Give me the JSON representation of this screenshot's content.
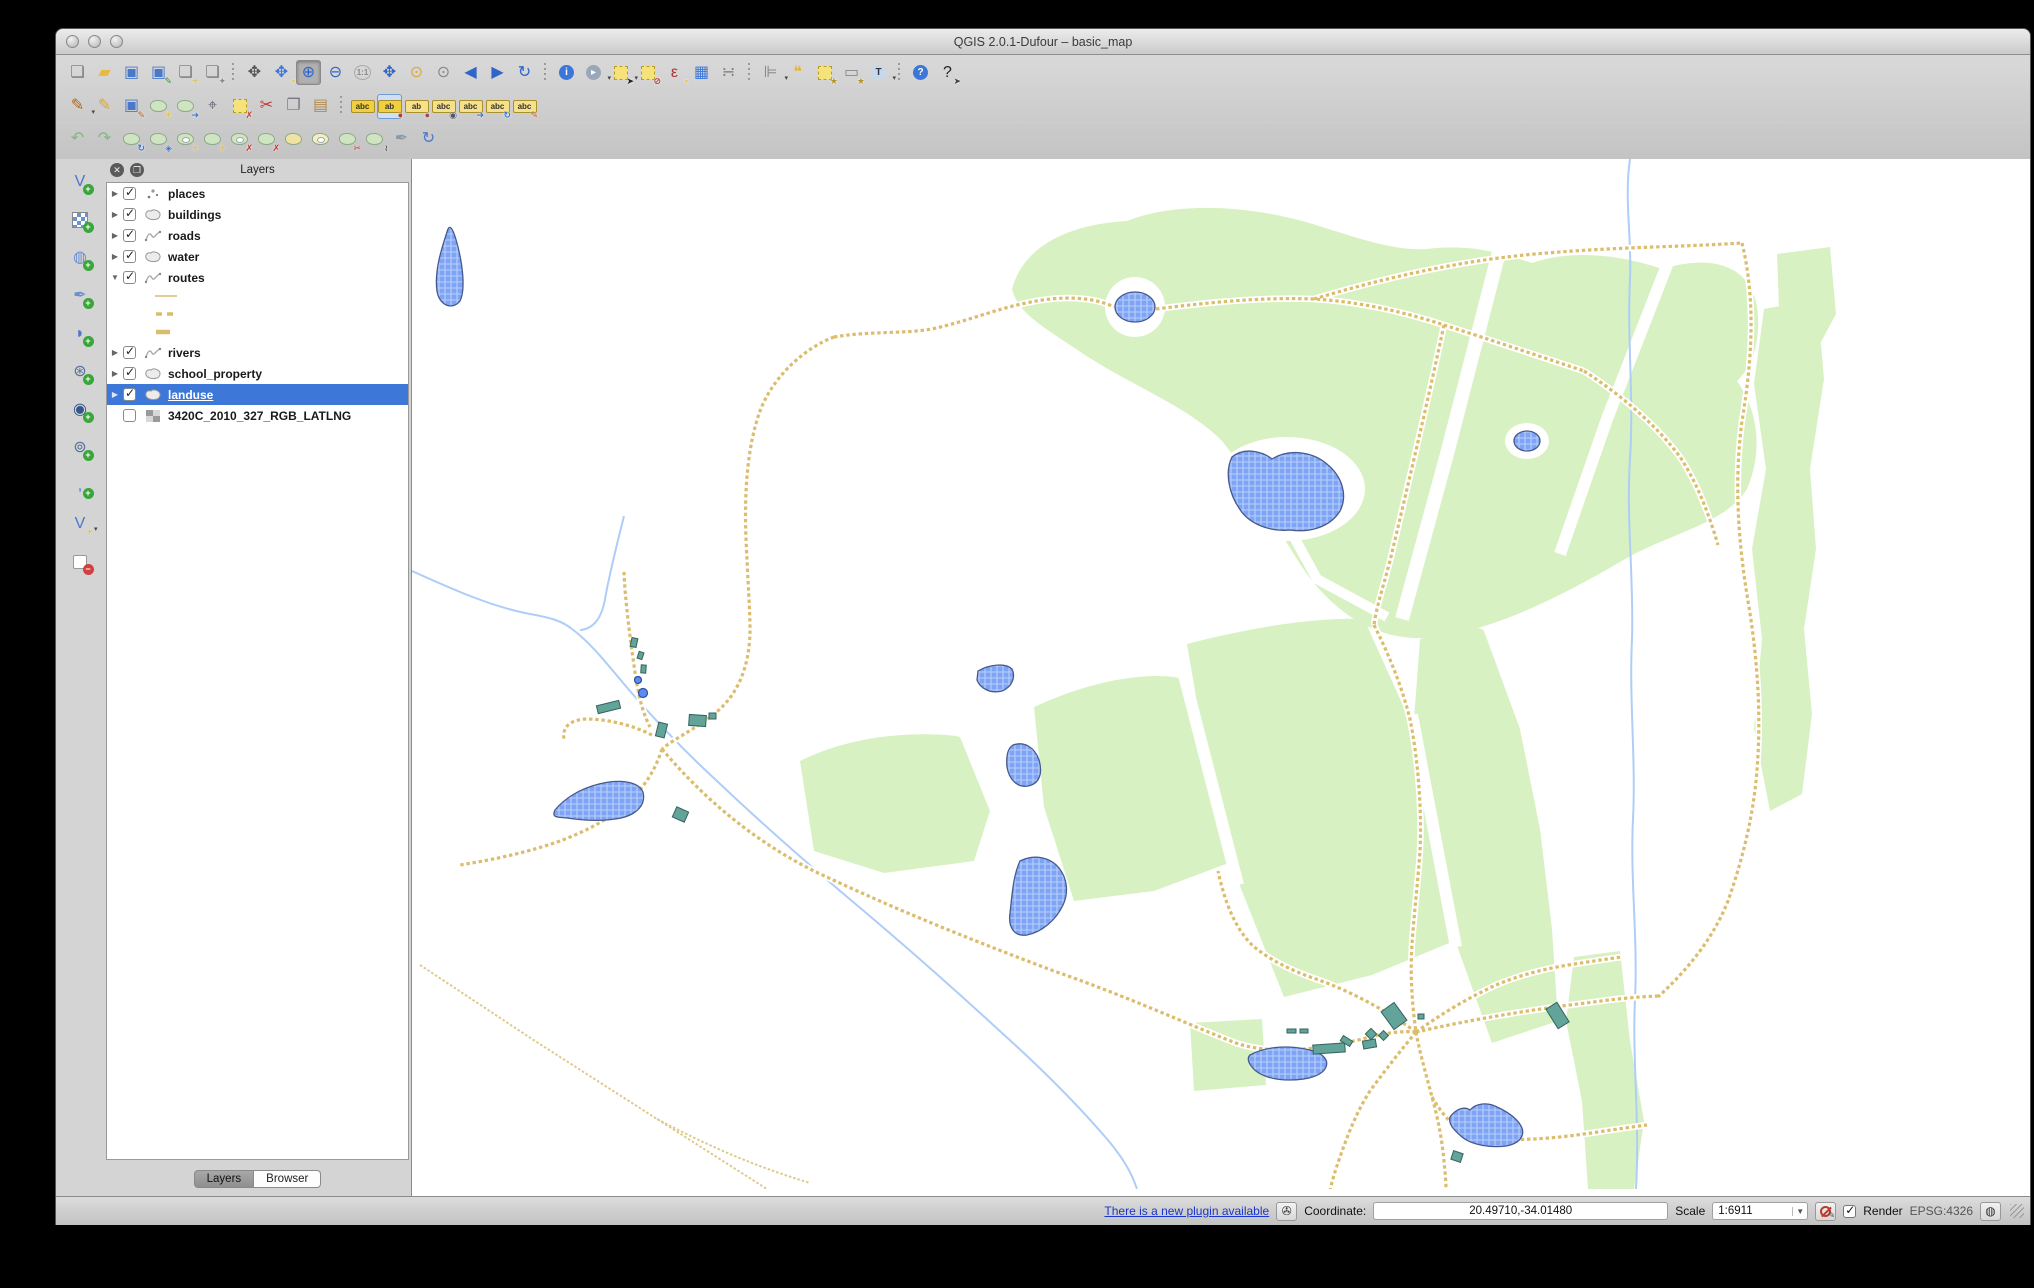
{
  "window": {
    "title": "QGIS 2.0.1-Dufour – basic_map"
  },
  "colors": {
    "selection_blue": "#3d78d8",
    "landuse_green": "#d8f1c2",
    "water_fill": "#7da4f5",
    "water_border": "#46598f",
    "route_tan": "#dcbd6e",
    "river_blue": "#aecdf7",
    "building_teal": "#62a39a",
    "link_blue": "#1a35cc"
  },
  "toolbars": {
    "row1": [
      {
        "n": "new-project-button",
        "k": "g",
        "g": "❏",
        "c": "#777"
      },
      {
        "n": "open-project-button",
        "k": "g",
        "g": "▰",
        "c": "#e9b93f"
      },
      {
        "n": "save-project-button",
        "k": "g",
        "g": "▣",
        "c": "#4a79c9"
      },
      {
        "n": "save-project-as-button",
        "k": "g",
        "g": "▣",
        "c": "#4a79c9",
        "b": "✎",
        "bc": "#2a8a2a"
      },
      {
        "n": "new-print-composer-button",
        "k": "g",
        "g": "❏",
        "c": "#777",
        "b": "✳",
        "bc": "#d8b93c"
      },
      {
        "n": "composer-manager-button",
        "k": "g",
        "g": "❏",
        "c": "#777",
        "b": "✦",
        "bc": "#888"
      },
      {
        "s": 1
      },
      {
        "n": "pan-map-button",
        "k": "g",
        "g": "✥",
        "c": "#555"
      },
      {
        "n": "pan-to-selection-button",
        "k": "g",
        "g": "✥",
        "c": "#3b76d8",
        "b": "▪",
        "bc": "#e8c83c"
      },
      {
        "n": "zoom-in-button",
        "k": "g",
        "g": "⊕",
        "c": "#2f66c8",
        "p": 1
      },
      {
        "n": "zoom-out-button",
        "k": "g",
        "g": "⊖",
        "c": "#2f66c8"
      },
      {
        "n": "zoom-actual-size-button",
        "k": "mini",
        "g": "1:1"
      },
      {
        "n": "zoom-full-extent-button",
        "k": "g",
        "g": "✥",
        "c": "#2f66c8"
      },
      {
        "n": "zoom-to-selection-button",
        "k": "g",
        "g": "⊙",
        "c": "#d8a93c"
      },
      {
        "n": "zoom-to-layer-button",
        "k": "g",
        "g": "⊙",
        "c": "#888"
      },
      {
        "n": "zoom-last-button",
        "k": "g",
        "g": "◀",
        "c": "#2f66c8"
      },
      {
        "n": "zoom-next-button",
        "k": "g",
        "g": "▶",
        "c": "#2f66c8"
      },
      {
        "n": "refresh-map-button",
        "k": "g",
        "g": "↻",
        "c": "#2f66c8"
      },
      {
        "s": 1
      },
      {
        "n": "identify-features-button",
        "k": "circ",
        "g": "i",
        "bg": "#3b76d8"
      },
      {
        "n": "run-feature-action-button",
        "k": "circ",
        "g": "▸",
        "bg": "#9aa7b8",
        "dd": 1
      },
      {
        "n": "select-features-button",
        "k": "sq",
        "b": "➤",
        "bc": "#222",
        "dd": 1
      },
      {
        "n": "deselect-features-button",
        "k": "sq",
        "b": "⊘",
        "bc": "#c0392b"
      },
      {
        "n": "select-by-expression-button",
        "k": "g",
        "g": "ε",
        "c": "#b03030",
        "b": "▪",
        "bc": "#e8c83c"
      },
      {
        "n": "open-attribute-table-button",
        "k": "g",
        "g": "▦",
        "c": "#3b76d8"
      },
      {
        "n": "field-calculator-button",
        "k": "g",
        "g": "∺",
        "c": "#777"
      },
      {
        "s": 1
      },
      {
        "n": "measure-line-button",
        "k": "g",
        "g": "⊫",
        "c": "#888",
        "dd": 1
      },
      {
        "n": "map-tips-button",
        "k": "g",
        "g": "❝",
        "c": "#e0b63c"
      },
      {
        "n": "new-bookmark-button",
        "k": "sq",
        "b": "★",
        "bc": "#b8932c"
      },
      {
        "n": "show-bookmarks-button",
        "k": "g",
        "g": "▭",
        "c": "#888",
        "b": "★",
        "bc": "#b8932c"
      },
      {
        "n": "text-annotation-button",
        "k": "circ",
        "g": "T",
        "bg": "#c8d8ec",
        "c": "#334",
        "dd": 1
      },
      {
        "s": 1
      },
      {
        "n": "help-contents-button",
        "k": "circ",
        "g": "?",
        "bg": "#3b76d8"
      },
      {
        "n": "whats-this-button",
        "k": "g",
        "g": "?",
        "c": "#222",
        "b": "➤",
        "bc": "#444"
      }
    ],
    "row2": [
      {
        "n": "current-edits-button",
        "k": "g",
        "g": "✎",
        "c": "#b5651d",
        "dd": 1
      },
      {
        "n": "toggle-editing-button",
        "k": "g",
        "g": "✎",
        "c": "#d8a93c"
      },
      {
        "n": "save-layer-edits-button",
        "k": "g",
        "g": "▣",
        "c": "#4a79c9",
        "b": "✎",
        "bc": "#b5651d"
      },
      {
        "n": "add-feature-button",
        "k": "blob",
        "b": "✳",
        "bc": "#d8b93c"
      },
      {
        "n": "move-feature-button",
        "k": "blob",
        "b": "➜",
        "bc": "#3b76d8"
      },
      {
        "n": "node-tool-button",
        "k": "g",
        "g": "⌖",
        "c": "#667"
      },
      {
        "n": "delete-selected-button",
        "k": "sq",
        "b": "✗",
        "bc": "#c0392b"
      },
      {
        "n": "cut-features-button",
        "k": "g",
        "g": "✂",
        "c": "#c0392b"
      },
      {
        "n": "copy-features-button",
        "k": "g",
        "g": "❐",
        "c": "#778"
      },
      {
        "n": "paste-features-button",
        "k": "g",
        "g": "▤",
        "c": "#b08a4a"
      },
      {
        "s": 1
      },
      {
        "n": "layer-labeling-options-button",
        "k": "tag",
        "g": "abc",
        "bg": "#f2cf3e"
      },
      {
        "n": "pin-unpin-labels-button",
        "k": "tag",
        "g": "ab",
        "bg": "#f2cf3e",
        "b": "●",
        "bc": "#c0392b",
        "p": 2
      },
      {
        "n": "highlight-pinned-labels-button",
        "k": "tag",
        "g": "ab",
        "bg": "#f6e08a",
        "b": "●",
        "bc": "#a04a5a"
      },
      {
        "n": "show-hide-labels-button",
        "k": "tag",
        "g": "abc",
        "bg": "#f6e08a",
        "b": "◉",
        "bc": "#556"
      },
      {
        "n": "move-label-button",
        "k": "tag",
        "g": "abc",
        "bg": "#f6e08a",
        "b": "➜",
        "bc": "#3b76d8"
      },
      {
        "n": "rotate-label-button",
        "k": "tag",
        "g": "abc",
        "bg": "#f6e08a",
        "b": "↻",
        "bc": "#3b76d8"
      },
      {
        "n": "change-label-properties-button",
        "k": "tag",
        "g": "abc",
        "bg": "#f6e08a",
        "b": "✎",
        "bc": "#b5651d"
      }
    ],
    "row3": [
      {
        "n": "undo-button",
        "k": "g",
        "g": "↶",
        "c": "#82b880"
      },
      {
        "n": "redo-button",
        "k": "g",
        "g": "↷",
        "c": "#82b880"
      },
      {
        "n": "rotate-feature-button",
        "k": "blob",
        "b": "↻",
        "bc": "#3b76d8"
      },
      {
        "n": "simplify-feature-button",
        "k": "blob",
        "b": "◈",
        "bc": "#3b76d8"
      },
      {
        "n": "add-ring-button",
        "k": "ring",
        "b": "✳",
        "bc": "#d8b93c"
      },
      {
        "n": "add-part-button",
        "k": "blob",
        "b": "✳",
        "bc": "#d8b93c"
      },
      {
        "n": "delete-ring-button",
        "k": "ring",
        "b": "✗",
        "bc": "#c0392b"
      },
      {
        "n": "delete-part-button",
        "k": "blob",
        "b": "✗",
        "bc": "#c0392b"
      },
      {
        "n": "fill-ring-button",
        "k": "blob",
        "bg": "#efe3a2"
      },
      {
        "n": "reshape-features-button",
        "k": "ring",
        "bg": "#f4eec2"
      },
      {
        "n": "split-features-button",
        "k": "blob",
        "b": "✂",
        "bc": "#c0392b"
      },
      {
        "n": "split-parts-button",
        "k": "blob",
        "b": "≀",
        "bc": "#556"
      },
      {
        "n": "offset-curve-button",
        "k": "g",
        "g": "✒",
        "c": "#8899aa"
      },
      {
        "n": "rotate-point-symbols-button",
        "k": "g",
        "g": "↻",
        "c": "#4a79c9"
      }
    ],
    "left": [
      {
        "n": "add-vector-layer-button",
        "k": "g",
        "g": "V",
        "c": "#4a79c9",
        "b": "+",
        "bbg": "#3aa53a"
      },
      {
        "n": "add-raster-layer-button",
        "k": "chk",
        "b": "+",
        "bbg": "#3aa53a"
      },
      {
        "n": "add-postgis-layer-button",
        "k": "g",
        "g": "◍",
        "c": "#6a8fd0",
        "b": "+",
        "bbg": "#3aa53a"
      },
      {
        "n": "add-spatialite-layer-button",
        "k": "g",
        "g": "✒",
        "c": "#6a8fd0",
        "b": "+",
        "bbg": "#3aa53a"
      },
      {
        "n": "add-mssql-layer-button",
        "k": "g",
        "g": "◗",
        "c": "#4a79c9",
        "b": "+",
        "bbg": "#3aa53a"
      },
      {
        "n": "add-wms-layer-button",
        "k": "g",
        "g": "⊛",
        "c": "#55719a",
        "b": "+",
        "bbg": "#3aa53a"
      },
      {
        "n": "add-wcs-layer-button",
        "k": "g",
        "g": "◉",
        "c": "#33578a",
        "b": "+",
        "bbg": "#3aa53a"
      },
      {
        "n": "add-wfs-layer-button",
        "k": "g",
        "g": "⊚",
        "c": "#55719a",
        "b": "+",
        "bbg": "#3aa53a"
      },
      {
        "n": "add-delimited-text-layer-button",
        "k": "g",
        "g": ",",
        "c": "#4a79c9",
        "b": "+",
        "bbg": "#3aa53a"
      },
      {
        "n": "new-shapefile-layer-button",
        "k": "g",
        "g": "V",
        "c": "#4a79c9",
        "b": "✳",
        "bc": "#d8b93c",
        "dd": 1
      },
      {
        "n": "remove-layer-button",
        "k": "sqw",
        "b": "−",
        "bbg": "#d04040"
      }
    ]
  },
  "layers_panel": {
    "title": "Layers",
    "tab_layers": "Layers",
    "tab_browser": "Browser",
    "layers": [
      {
        "name": "places",
        "icon": "point",
        "checked": true,
        "expander": "right"
      },
      {
        "name": "buildings",
        "icon": "polygon",
        "checked": true,
        "expander": "right"
      },
      {
        "name": "roads",
        "icon": "line",
        "checked": true,
        "expander": "right"
      },
      {
        "name": "water",
        "icon": "polygon",
        "checked": true,
        "expander": "right"
      },
      {
        "name": "routes",
        "icon": "line",
        "checked": true,
        "expander": "down",
        "children": [
          "line-solid",
          "line-dashes",
          "line-thick"
        ]
      },
      {
        "name": "rivers",
        "icon": "line",
        "checked": true,
        "expander": "right"
      },
      {
        "name": "school_property",
        "icon": "polygon",
        "checked": true,
        "expander": "right"
      },
      {
        "name": "landuse",
        "icon": "polygon",
        "checked": true,
        "expander": "right",
        "selected": true
      },
      {
        "name": "3420C_2010_327_RGB_LATLNG",
        "icon": "raster",
        "checked": false,
        "expander": "none"
      }
    ]
  },
  "status_bar": {
    "plugin_link": "There is a new plugin available",
    "coordinate_label": "Coordinate:",
    "coordinate_value": "20.49710,-34.01480",
    "scale_label": "Scale",
    "scale_value": "1:6911",
    "render_label": "Render",
    "render_checked": true,
    "crs_label": "EPSG:4326"
  }
}
